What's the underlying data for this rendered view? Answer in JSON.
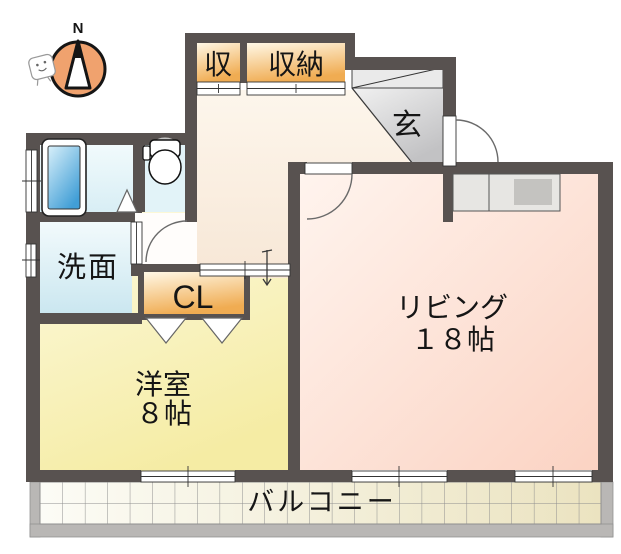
{
  "compass": {
    "north_label": "N"
  },
  "rooms": {
    "storage_small": {
      "label": "収"
    },
    "storage_large": {
      "label": "収納"
    },
    "entrance": {
      "label": "玄"
    },
    "washroom": {
      "label": "洗面"
    },
    "closet": {
      "label": "CL"
    },
    "western_room": {
      "label": "洋室",
      "size": "８帖"
    },
    "living_room": {
      "label": "リビング",
      "size": "１８帖"
    },
    "balcony": {
      "label": "バルコニー"
    }
  },
  "colors": {
    "wall": "#585250",
    "living_room_fill": "#FBD8C9",
    "western_room_fill": "#F6EDA8",
    "hallway_fill": "#F9EEDF",
    "closet_fill": "#F1AE55",
    "water_area_fill": "#DDF0F7",
    "bathtub_fill": "#47A3DA",
    "entrance_fill": "#C9C9CB",
    "balcony_tile_fill": "#EDE5C4",
    "compass_circle_fill": "#F0A26E"
  }
}
